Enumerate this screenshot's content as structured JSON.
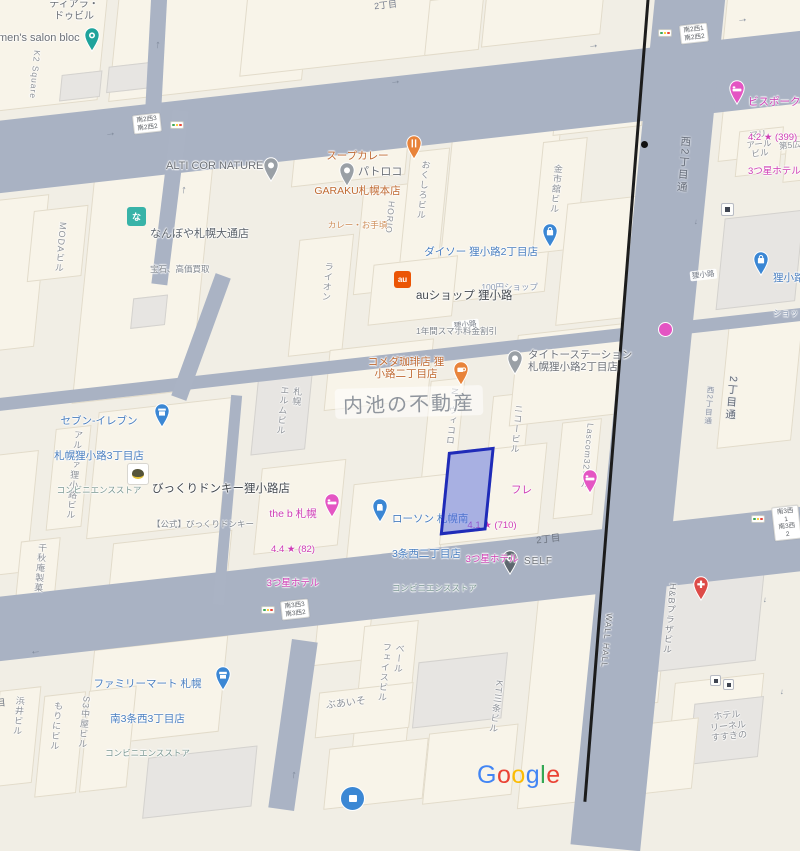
{
  "watermark": {
    "text": "内池の不動産"
  },
  "brand": {
    "google": "Google",
    "google_colors": [
      "#4285F4",
      "#EA4335",
      "#FBBC05",
      "#4285F4",
      "#34A853",
      "#EA4335"
    ]
  },
  "colors": {
    "road": "#a9b2c3",
    "selection_border": "#1f2bb8",
    "selection_fill": "rgba(88,108,220,.5)",
    "hotel_pink": "#cf3db4",
    "store_blue": "#4a7fc0",
    "food_orange": "#c06a32"
  },
  "road_labels": {
    "nishi2chome_dori": "西2丁目通",
    "nishi2chome_dori_2": "2丁目通",
    "nishi2chome_dori_3": "西2丁目通",
    "tanukikoji_on_road_1": "狸小路",
    "tanukikoji_on_road_2": "狸小路",
    "nichome_top": "2丁目",
    "nichome_south": "2丁目",
    "me_partial": "目"
  },
  "intersections": {
    "s2w3": {
      "top": "南2西3",
      "bottom": "南2西2"
    },
    "s2w1": {
      "top": "南2西1",
      "bottom": "南2西2"
    },
    "s3w3": {
      "top": "南3西3",
      "bottom": "南3西2"
    },
    "s3w1": {
      "top": "南3西1",
      "bottom": "南3西2"
    }
  },
  "pois": {
    "mens_salon_bloc": {
      "name": "men's salon bloc"
    },
    "tiara": {
      "lines": "ティアラ・\nドゥビル"
    },
    "k2_square": {
      "name": "K2 Square"
    },
    "garaku": {
      "l1": "スープカレー",
      "l2": "GARAKU札幌本店",
      "sub": "カレー・お手頃"
    },
    "patoroko": {
      "name": "パトロコ"
    },
    "nanboya": {
      "name": "なんぼや札幌大通店",
      "sub": "宝石、高価買取",
      "logo": "な"
    },
    "alti_cor_nature": {
      "name": "ALTI COR NATURE"
    },
    "daiso": {
      "name": "ダイソー 狸小路2丁目店",
      "sub": "100円ショップ"
    },
    "au_shop": {
      "name": "auショップ 狸小路",
      "sub": "1年間スマホ料金割引",
      "logo": "au"
    },
    "komeda": {
      "lines": "コメダ珈琲店 狸\n小路二丁目店"
    },
    "taito": {
      "lines": "タイトーステーション\n札幌狸小路2丁目店"
    },
    "seven_eleven": {
      "l1": "セブン-イレブン",
      "l2": "札幌狸小路3丁目店",
      "sub": "コンビニエンスストア"
    },
    "bikkuri_donkey": {
      "name": "びっくりドンキー狸小路店",
      "sub": "【公式】びっくりドンキー"
    },
    "the_b_sapporo": {
      "l1": "the b 札幌",
      "l2": "4.4 ★ (82)",
      "l3": "3つ星ホテル"
    },
    "lawson": {
      "l1": "ローソン 札幌南",
      "l2": "3条西二丁目店",
      "sub": "コンビニエンスストア"
    },
    "fre_hotel": {
      "l1": "フレ",
      "l2": "4.1 ★ (710)",
      "l3": "3つ星ホテル"
    },
    "self_parking": {
      "name": "SELF"
    },
    "family_mart": {
      "l1": "ファミリーマート 札幌",
      "l2": "南3条西3丁目店",
      "sub": "コンビニエンスストア"
    },
    "bespoke": {
      "l1": "ビスポーク",
      "l2": "4.2 ★ (399)",
      "l3": "3つ星ホテル"
    },
    "tanukikoji_arcade": {
      "name": "狸小路",
      "sub": "ショッ"
    }
  },
  "buildings": {
    "moda": "MODAビル",
    "lion": "ライオン",
    "horio": "HORIO",
    "okushiro": "おくしろビル",
    "kinshikan": "金市舘ビル",
    "elm": "札幌\nエルムビル",
    "n_vicolo": "N・ヴィコロ",
    "nico": "ニコービル",
    "lascom": "Lascom32ビル",
    "alpha": "アルファ狸小路ビル",
    "senshuan": "千秋庵製菓",
    "hamai": "浜井ビル",
    "morini": "もりにビル",
    "s3_nakaya": "S3中屋ビル",
    "buaiso": "ぶあいそ",
    "veil_face": "ベール\nフェイスビル",
    "kt_sanjo": "KT三条ビル",
    "wall_hall": "WALL HALL",
    "hb_plaza": "H&Bプラザビル",
    "hotel_lienel": "ホテル\nリーネル\nすすきの",
    "mariail": "マリ\nアール\nビル",
    "dai5": "第5広"
  }
}
